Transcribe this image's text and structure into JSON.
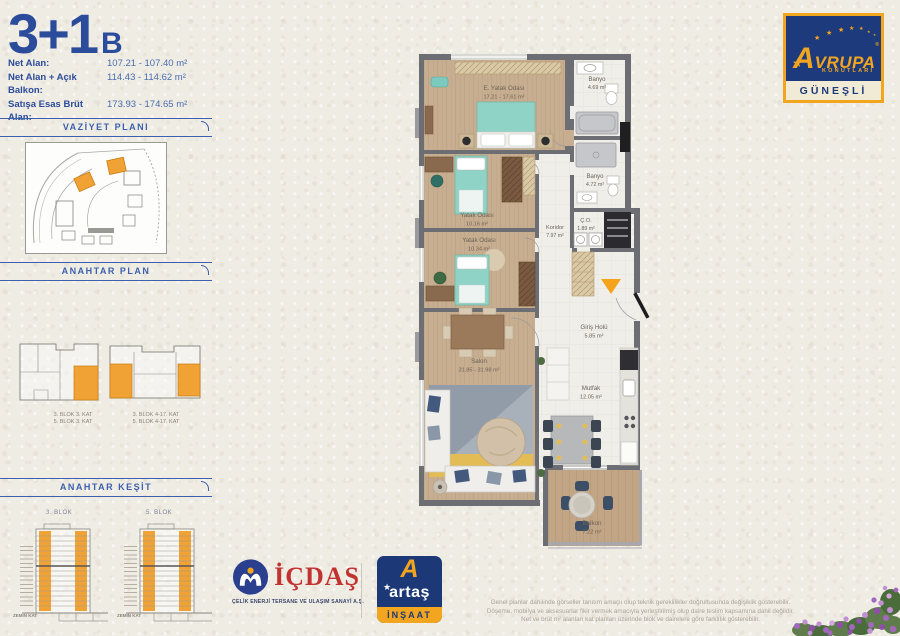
{
  "title": {
    "main": "3+1",
    "variant": "B"
  },
  "specs": [
    {
      "label": "Net Alan:",
      "value": "107.21 - 107.40 m²"
    },
    {
      "label": "Net Alan + Açık Balkon:",
      "value": "114.43 - 114.62 m²"
    },
    {
      "label": "Satışa Esas Brüt Alan:",
      "value": "173.93 - 174.65 m²"
    }
  ],
  "sidebar": {
    "vaziyet_title": "VAZİYET PLANI",
    "anahtar_plan_title": "ANAHTAR PLAN",
    "anahtar_kesit_title": "ANAHTAR KEŞİT",
    "key_plans": [
      {
        "line1": "3. BLOK 3. KAT",
        "line2": "5. BLOK 3. KAT"
      },
      {
        "line1": "3. BLOK 4-17. KAT",
        "line2": "5. BLOK 4-17. KAT"
      }
    ],
    "kesit": [
      {
        "blok": "3. BLOK",
        "ground": "ZEMİN KAT"
      },
      {
        "blok": "5. BLOK",
        "ground": "ZEMİN KAT"
      }
    ]
  },
  "plan": {
    "rooms": {
      "master": {
        "name": "E. Yatak Odası",
        "area": "17.21 - 17.61 m²"
      },
      "banyo1": {
        "name": "Banyo",
        "area": "4.69 m²"
      },
      "banyo2": {
        "name": "Banyo",
        "area": "4.72 m²"
      },
      "bedroom2": {
        "name": "Yatak Odası",
        "area": "10.16 m²"
      },
      "bedroom3": {
        "name": "Yatak Odası",
        "area": "10.34 m²"
      },
      "koridor": {
        "name": "Koridor",
        "area": "7.97 m²"
      },
      "co": {
        "name": "Ç.O.",
        "area": "1.89 m²"
      },
      "giris": {
        "name": "Giriş Holü",
        "area": "5.85 m²"
      },
      "salon": {
        "name": "Salon",
        "area": "31.85 - 31.98 m²"
      },
      "mutfak": {
        "name": "Mutfak",
        "area": "12.05 m²"
      },
      "balkon": {
        "name": "Balkon",
        "area": "7.22 m²"
      }
    }
  },
  "logos": {
    "avrupa": {
      "name": "AVRUPA",
      "reg": "®",
      "sub": "KONUTLARI",
      "project": "GÜNEŞLİ"
    },
    "icdas": {
      "name": "İÇDAŞ",
      "caption": "ÇELİK ENERJİ TERSANE VE ULAŞIM SANAYİ A.Ş."
    },
    "artas": {
      "name": "artaş",
      "sub": "İNŞAAT",
      "mark": "A"
    }
  },
  "disclaimer": {
    "line1": "Genel planlar dahilinde görseller tanıtım amaçlı olup teknik gereklilikler doğrultusunda değişiklik gösterebilir.",
    "line2": "Döşeme, mobilya ve aksesuarlar fikir vermek amacıyla yerleştirilmiş olup daire teslim kapsamına dahil değildir.",
    "line3": "Net ve brüt m² alanları kat planları üzerinde blok ve dairelere göre farklılık gösterebilir."
  },
  "colors": {
    "brand_blue": "#2b4b9b",
    "brand_orange": "#f2a51f",
    "icdas_red": "#c23230",
    "wall_gray": "#6d6e73"
  }
}
